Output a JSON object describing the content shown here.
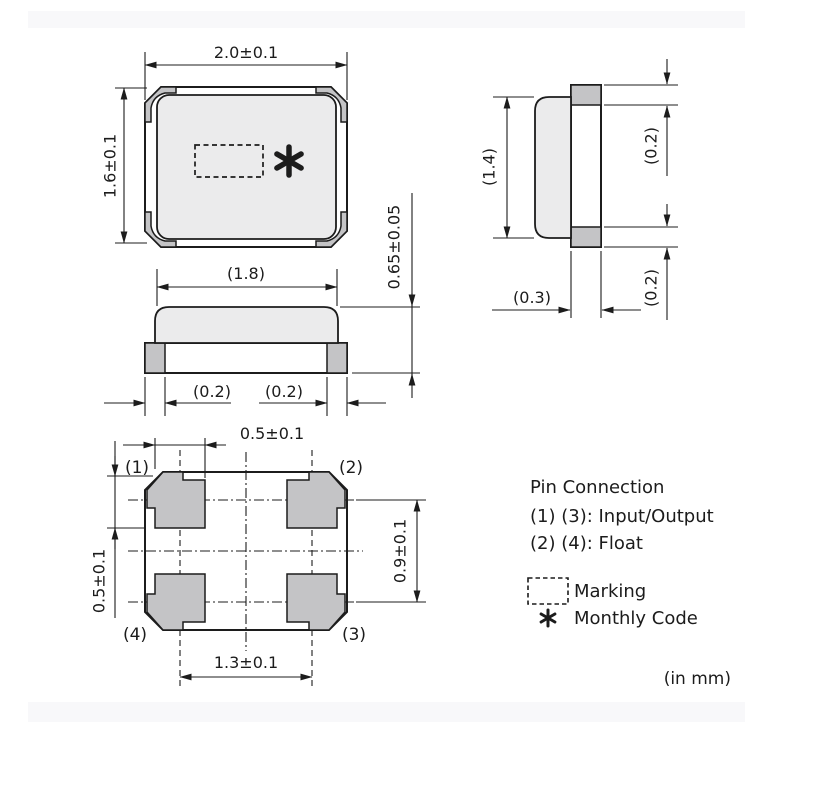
{
  "colors": {
    "line": "#1c1c1c",
    "lid_fill": "#ebebec",
    "pad_fill": "#c4c4c6",
    "bar_fill": "#f8f8fa"
  },
  "drawing": {
    "top_view": {
      "width_dim": "2.0±0.1",
      "height_dim": "1.6±0.1",
      "thickness_dim": "0.65±0.05"
    },
    "front_view": {
      "lid_width_dim": "(1.8)",
      "left_pad_dim": "(0.2)",
      "right_pad_dim": "(0.2)"
    },
    "side_view": {
      "lid_height_dim": "(1.4)",
      "top_pad_dim": "(0.2)",
      "bottom_pad_dim": "(0.2)",
      "base_width_dim": "(0.3)"
    },
    "bottom_view": {
      "pad_width_dim": "0.5±0.1",
      "pad_height_dim": "0.5±0.1",
      "pad_pitch_h_dim": "1.3±0.1",
      "pad_pitch_v_dim": "0.9±0.1",
      "pins": {
        "p1": "(1)",
        "p2": "(2)",
        "p3": "(3)",
        "p4": "(4)"
      }
    },
    "notes": {
      "pin_connection_title": "Pin Connection",
      "pin_connection_io": "(1) (3): Input/Output",
      "pin_connection_float": "(2) (4): Float",
      "marking_label": "Marking",
      "monthly_code_label": "Monthly Code",
      "units_note": "(in mm)"
    }
  }
}
